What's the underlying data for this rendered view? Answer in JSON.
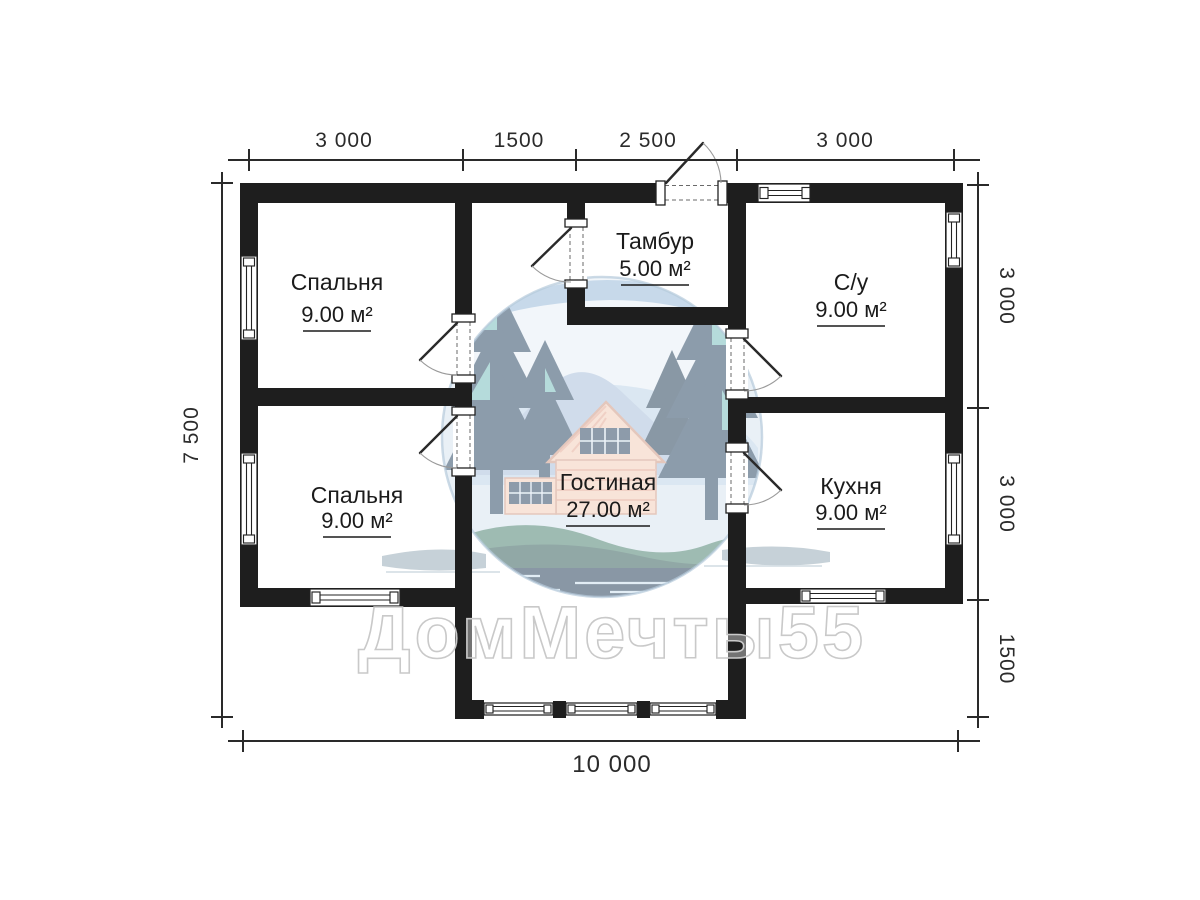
{
  "plan": {
    "rooms": [
      {
        "name": "Спальня",
        "area": "9.00 м²"
      },
      {
        "name": "Тамбур",
        "area": "5.00 м²"
      },
      {
        "name": "С/у",
        "area": "9.00 м²"
      },
      {
        "name": "Спальня",
        "area": "9.00 м²"
      },
      {
        "name": "Кухня",
        "area": "9.00 м²"
      },
      {
        "name": "Гостиная",
        "area": "27.00 м²"
      }
    ],
    "dimensions": {
      "top": [
        "3 000",
        "1500",
        "2 500",
        "3 000"
      ],
      "left": [
        "7 500"
      ],
      "right": [
        "3 000",
        "3 000",
        "1500"
      ],
      "bottom": [
        "10 000"
      ]
    },
    "colors": {
      "wall": "#1e1e1e",
      "dimension_line": "#2a2a2a",
      "label_text": "#1b1b1b"
    }
  },
  "watermark": {
    "text": "ДомМечты55",
    "logo": "forest-house-circle-logo",
    "stroke": "#c9c9c9"
  }
}
